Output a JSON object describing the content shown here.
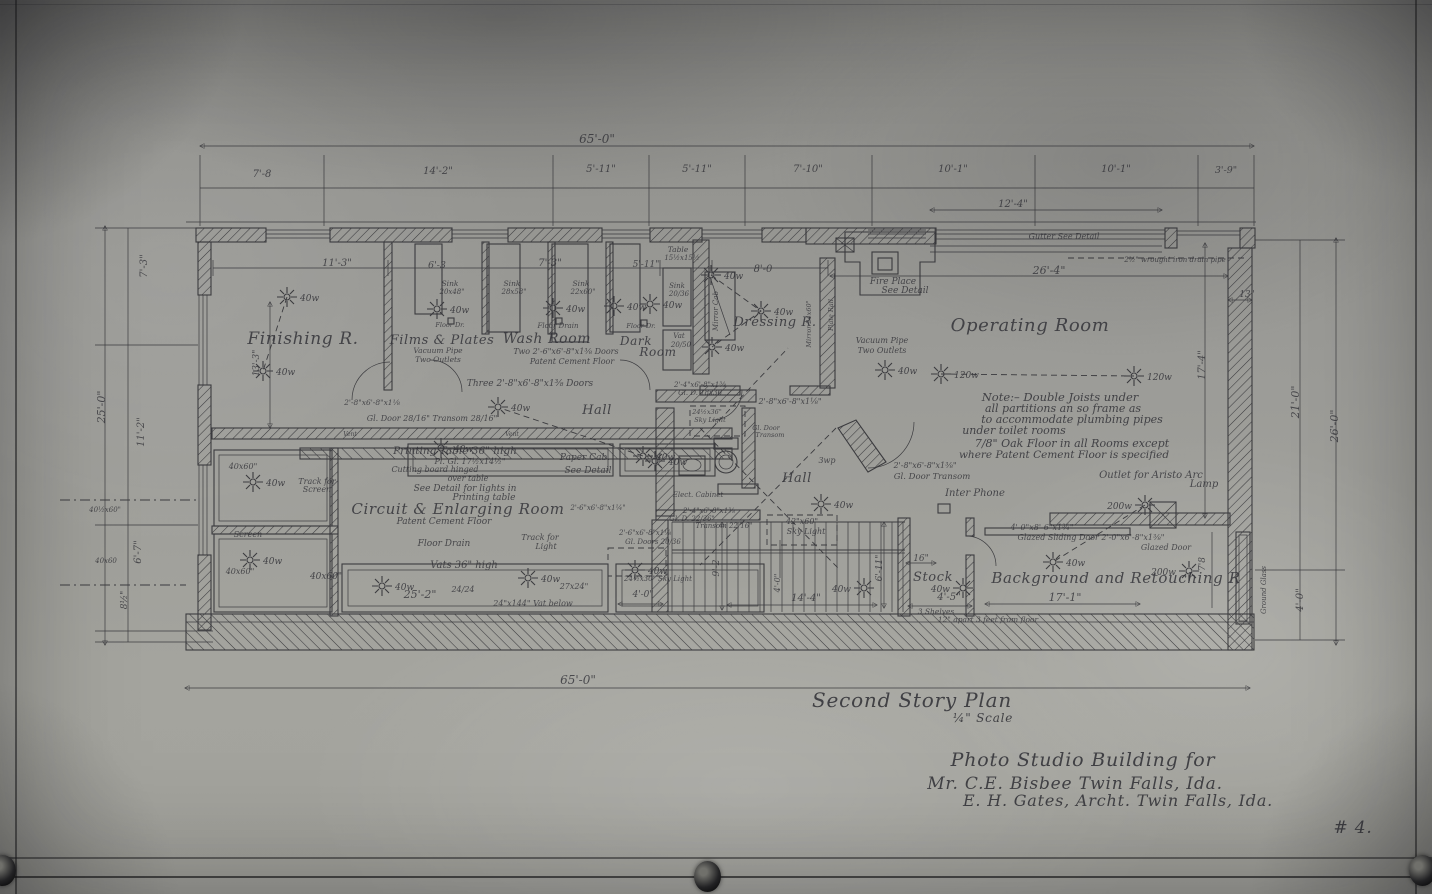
{
  "drawing": {
    "plan_title": "Second Story Plan",
    "scale": "¼\" Scale",
    "project": "Photo Studio Building for",
    "client": "Mr. C.E. Bisbee    Twin Falls, Ida.",
    "architect": "E. H. Gates, Archt.  Twin Falls, Ida.",
    "sheet_number": "# 4."
  },
  "colors": {
    "paper": "#9a9a96",
    "ink": "#26262b"
  },
  "texts": [
    {
      "t": "Finishing R.",
      "x": 303,
      "y": 344,
      "s": 17,
      "st": "room",
      "n": "room-label-finishing"
    },
    {
      "t": "Films & Plates",
      "x": 442,
      "y": 344,
      "s": 13,
      "st": "room",
      "n": "room-label-films-plates"
    },
    {
      "t": "Wash Room",
      "x": 547,
      "y": 343,
      "s": 14,
      "st": "room",
      "n": "room-label-wash-room"
    },
    {
      "t": "Dark",
      "x": 636,
      "y": 345,
      "s": 12,
      "st": "room",
      "n": "room-label-dark"
    },
    {
      "t": "Room",
      "x": 658,
      "y": 356,
      "s": 12,
      "st": "room",
      "n": "room-label-dark-2"
    },
    {
      "t": "Dressing R.",
      "x": 775,
      "y": 326,
      "s": 13,
      "st": "room",
      "n": "room-label-dressing"
    },
    {
      "t": "Operating Room",
      "x": 1030,
      "y": 331,
      "s": 18,
      "st": "room",
      "n": "room-label-operating"
    },
    {
      "t": "Hall",
      "x": 597,
      "y": 414,
      "s": 13,
      "st": "room",
      "n": "room-label-hall-1"
    },
    {
      "t": "Hall",
      "x": 797,
      "y": 482,
      "s": 13,
      "st": "room",
      "n": "room-label-hall-2"
    },
    {
      "t": "Circuit & Enlarging Room",
      "x": 458,
      "y": 514,
      "s": 15,
      "st": "room",
      "n": "room-label-enlarging"
    },
    {
      "t": "Stock",
      "x": 933,
      "y": 581,
      "s": 13,
      "st": "room",
      "n": "room-label-stock"
    },
    {
      "t": "Background and Retouching R",
      "x": 1116,
      "y": 583,
      "s": 15,
      "st": "room",
      "n": "room-label-background"
    },
    {
      "t": "Second Story Plan",
      "x": 912,
      "y": 707,
      "s": 20,
      "st": "t",
      "n": "plan-title"
    },
    {
      "t": "¼\" Scale",
      "x": 983,
      "y": 722,
      "s": 12,
      "st": "t",
      "n": "plan-scale"
    },
    {
      "t": "Photo Studio Building for",
      "x": 1083,
      "y": 766,
      "s": 19,
      "st": "t",
      "n": "project-title"
    },
    {
      "t": "Mr. C.E. Bisbee    Twin Falls, Ida.",
      "x": 1075,
      "y": 789,
      "s": 17,
      "st": "t",
      "n": "client-line"
    },
    {
      "t": "E. H. Gates, Archt.  Twin Falls, Ida.",
      "x": 1118,
      "y": 806,
      "s": 16,
      "st": "t",
      "n": "architect-line"
    },
    {
      "t": "# 4.",
      "x": 1353,
      "y": 833,
      "s": 17,
      "st": "t",
      "n": "sheet-number"
    },
    {
      "t": "Note:– Double Joists under",
      "x": 1060,
      "y": 401,
      "s": 11.5,
      "st": "n"
    },
    {
      "t": "all partitions an so frame as",
      "x": 1063,
      "y": 412,
      "s": 11,
      "st": "n"
    },
    {
      "t": "to accommodate plumbing pipes",
      "x": 1072,
      "y": 423,
      "s": 11,
      "st": "n"
    },
    {
      "t": "under toilet rooms",
      "x": 1014,
      "y": 434,
      "s": 11,
      "st": "n"
    },
    {
      "t": "7/8\" Oak Floor in all Rooms except",
      "x": 1072,
      "y": 447,
      "s": 11,
      "st": "n"
    },
    {
      "t": "where Patent Cement Floor is specified",
      "x": 1064,
      "y": 458,
      "s": 10.5,
      "st": "n"
    },
    {
      "t": "65'-0\"",
      "x": 597,
      "y": 143,
      "s": 12,
      "st": "d"
    },
    {
      "t": "7'-8",
      "x": 262,
      "y": 177,
      "s": 10,
      "st": "d"
    },
    {
      "t": "14'-2\"",
      "x": 438,
      "y": 174,
      "s": 10,
      "st": "d"
    },
    {
      "t": "5'-11\"",
      "x": 601,
      "y": 172,
      "s": 10,
      "st": "d"
    },
    {
      "t": "5'-11\"",
      "x": 697,
      "y": 172,
      "s": 10,
      "st": "d"
    },
    {
      "t": "7'-10\"",
      "x": 808,
      "y": 172,
      "s": 10,
      "st": "d"
    },
    {
      "t": "10'-1\"",
      "x": 953,
      "y": 172,
      "s": 10,
      "st": "d"
    },
    {
      "t": "10'-1\"",
      "x": 1116,
      "y": 172,
      "s": 10,
      "st": "d"
    },
    {
      "t": "3'-9\"",
      "x": 1226,
      "y": 173,
      "s": 9.5,
      "st": "d"
    },
    {
      "t": "12'-4\"",
      "x": 1013,
      "y": 207,
      "s": 10,
      "st": "d"
    },
    {
      "t": "26'-4\"",
      "x": 1049,
      "y": 274,
      "s": 11,
      "st": "d"
    },
    {
      "t": "13\"",
      "x": 1247,
      "y": 297,
      "s": 9,
      "st": "d"
    },
    {
      "t": "11'-3\"",
      "x": 337,
      "y": 266,
      "s": 10,
      "st": "d"
    },
    {
      "t": "6'-3",
      "x": 437,
      "y": 268,
      "s": 9.5,
      "st": "d"
    },
    {
      "t": "7'-3\"",
      "x": 550,
      "y": 266,
      "s": 10,
      "st": "d"
    },
    {
      "t": "5'-11\"",
      "x": 646,
      "y": 267,
      "s": 9,
      "st": "d"
    },
    {
      "t": "8'-0",
      "x": 763,
      "y": 272,
      "s": 10,
      "st": "d"
    },
    {
      "t": "65'-0\"",
      "x": 578,
      "y": 684,
      "s": 12,
      "st": "d"
    },
    {
      "t": "25'-2\"",
      "x": 420,
      "y": 598,
      "s": 11,
      "st": "d"
    },
    {
      "t": "14'-4\"",
      "x": 806,
      "y": 601,
      "s": 10,
      "st": "d"
    },
    {
      "t": "17'-1\"",
      "x": 1065,
      "y": 601,
      "s": 11,
      "st": "d"
    },
    {
      "t": "4'-5\"",
      "x": 949,
      "y": 600,
      "s": 10,
      "st": "d"
    },
    {
      "t": "16\"",
      "x": 921,
      "y": 561,
      "s": 9,
      "st": "d"
    },
    {
      "t": "4'-0\"",
      "x": 643,
      "y": 597,
      "s": 9,
      "st": "d"
    },
    {
      "t": "7'-3\"",
      "x": 147,
      "y": 266,
      "s": 10,
      "r": -90,
      "st": "d"
    },
    {
      "t": "25'-0\"",
      "x": 105,
      "y": 407,
      "s": 11,
      "r": -90,
      "st": "d"
    },
    {
      "t": "11'-2\"",
      "x": 144,
      "y": 432,
      "s": 10,
      "r": -90,
      "st": "d"
    },
    {
      "t": "6'-7\"",
      "x": 141,
      "y": 552,
      "s": 10,
      "r": -90,
      "st": "d"
    },
    {
      "t": "8½\"",
      "x": 127,
      "y": 600,
      "s": 9,
      "r": -90,
      "st": "d"
    },
    {
      "t": "13'-3\"",
      "x": 259,
      "y": 363,
      "s": 9,
      "r": -90,
      "st": "d"
    },
    {
      "t": "17'-4\"",
      "x": 1205,
      "y": 365,
      "s": 10,
      "r": -90,
      "st": "d"
    },
    {
      "t": "21'-0\"",
      "x": 1299,
      "y": 402,
      "s": 11,
      "r": -90,
      "st": "d"
    },
    {
      "t": "26'-0\"",
      "x": 1338,
      "y": 426,
      "s": 11,
      "r": -90,
      "st": "d"
    },
    {
      "t": "4'-0\"",
      "x": 1303,
      "y": 600,
      "s": 10,
      "r": -90,
      "st": "d"
    },
    {
      "t": "7'8",
      "x": 1205,
      "y": 564,
      "s": 9,
      "r": -90,
      "st": "d"
    },
    {
      "t": "9'-2",
      "x": 719,
      "y": 568,
      "s": 9,
      "r": -90,
      "st": "d"
    },
    {
      "t": "6'-11\"",
      "x": 882,
      "y": 568,
      "s": 9,
      "r": -90,
      "st": "d"
    },
    {
      "t": "4'-0\"",
      "x": 780,
      "y": 583,
      "s": 8,
      "r": -90,
      "st": "d"
    },
    {
      "t": "Table",
      "x": 678,
      "y": 252,
      "s": 7.5,
      "st": "a"
    },
    {
      "t": "15½x15½",
      "x": 682,
      "y": 260,
      "s": 7,
      "st": "a"
    },
    {
      "t": "Sink",
      "x": 450,
      "y": 286,
      "s": 7.5,
      "st": "a"
    },
    {
      "t": "20x48\"",
      "x": 452,
      "y": 294,
      "s": 7,
      "st": "a"
    },
    {
      "t": "Sink",
      "x": 512,
      "y": 286,
      "s": 7.5,
      "st": "a"
    },
    {
      "t": "28x58\"",
      "x": 514,
      "y": 294,
      "s": 7,
      "st": "a"
    },
    {
      "t": "Sink",
      "x": 581,
      "y": 286,
      "s": 7.5,
      "st": "a"
    },
    {
      "t": "22x60\"",
      "x": 583,
      "y": 294,
      "s": 7,
      "st": "a"
    },
    {
      "t": "Sink",
      "x": 677,
      "y": 288,
      "s": 7,
      "st": "a"
    },
    {
      "t": "20/36",
      "x": 679,
      "y": 296,
      "s": 7,
      "st": "a"
    },
    {
      "t": "Floor Dr.",
      "x": 450,
      "y": 327,
      "s": 6.5,
      "st": "a"
    },
    {
      "t": "Floor Drain",
      "x": 558,
      "y": 328,
      "s": 7,
      "st": "a"
    },
    {
      "t": "Floor Dr.",
      "x": 641,
      "y": 328,
      "s": 6.5,
      "st": "a"
    },
    {
      "t": "Vat",
      "x": 679,
      "y": 338,
      "s": 7,
      "st": "a"
    },
    {
      "t": "20/50",
      "x": 681,
      "y": 347,
      "s": 7,
      "st": "a"
    },
    {
      "t": "Fire Place",
      "x": 893,
      "y": 284,
      "s": 9,
      "st": "a"
    },
    {
      "t": "See Detail",
      "x": 905,
      "y": 293,
      "s": 9,
      "st": "a"
    },
    {
      "t": "Gutter See Detail",
      "x": 1064,
      "y": 239,
      "s": 8,
      "st": "a"
    },
    {
      "t": "2½\" wrought iron drain pipe",
      "x": 1175,
      "y": 262,
      "s": 7,
      "st": "a"
    },
    {
      "t": "Vacuum Pipe",
      "x": 438,
      "y": 353,
      "s": 7.5,
      "st": "a"
    },
    {
      "t": "Two Outlets",
      "x": 438,
      "y": 362,
      "s": 7.5,
      "st": "a"
    },
    {
      "t": "Two  2'-6\"x6'-8\"x1⅜  Doors",
      "x": 566,
      "y": 354,
      "s": 8,
      "st": "a"
    },
    {
      "t": "Patent Cement Floor",
      "x": 572,
      "y": 364,
      "s": 8,
      "st": "a"
    },
    {
      "t": "Three  2'-8\"x6'-8\"x1⅜  Doors",
      "x": 530,
      "y": 386,
      "s": 9,
      "st": "a"
    },
    {
      "t": "2'-8\"x6'-8\"x1⅛",
      "x": 372,
      "y": 405,
      "s": 7.5,
      "st": "a"
    },
    {
      "t": "Gl. Door 28/16\"  Transom 28/16\"",
      "x": 432,
      "y": 421,
      "s": 8,
      "st": "a"
    },
    {
      "t": "Mirror Cab",
      "x": 718,
      "y": 311,
      "s": 7,
      "r": -90,
      "st": "a"
    },
    {
      "t": "Mirror 24x60\"",
      "x": 811,
      "y": 324,
      "s": 6.5,
      "r": -90,
      "st": "a"
    },
    {
      "t": "Plate Rail",
      "x": 833,
      "y": 315,
      "s": 6.5,
      "r": -90,
      "st": "a"
    },
    {
      "t": "Vacuum Pipe",
      "x": 882,
      "y": 343,
      "s": 8,
      "st": "a"
    },
    {
      "t": "Two Outlets",
      "x": 882,
      "y": 353,
      "s": 8,
      "st": "a"
    },
    {
      "t": "2'-4\"x6'-8\"x1⅜",
      "x": 700,
      "y": 387,
      "s": 7,
      "st": "a"
    },
    {
      "t": "Gl. D. 18x36",
      "x": 700,
      "y": 395,
      "s": 7,
      "st": "a"
    },
    {
      "t": "24½x36\"",
      "x": 707,
      "y": 414,
      "s": 6.5,
      "st": "a"
    },
    {
      "t": "Sky Light",
      "x": 710,
      "y": 422,
      "s": 6.5,
      "st": "a"
    },
    {
      "t": "2'-8\"x6'-8\"x1⅛\"",
      "x": 790,
      "y": 404,
      "s": 8,
      "st": "a"
    },
    {
      "t": "Gl. Door",
      "x": 766,
      "y": 430,
      "s": 6.5,
      "st": "a"
    },
    {
      "t": "Transom",
      "x": 770,
      "y": 437,
      "s": 6.5,
      "st": "a"
    },
    {
      "t": "3wp",
      "x": 827,
      "y": 463,
      "s": 8,
      "st": "a"
    },
    {
      "t": "2'-8\"x6'-8\"x1⅜\"",
      "x": 925,
      "y": 468,
      "s": 8,
      "st": "a"
    },
    {
      "t": "Gl. Door Transom",
      "x": 932,
      "y": 479,
      "s": 8.5,
      "st": "a"
    },
    {
      "t": "Inter Phone",
      "x": 975,
      "y": 496,
      "s": 10,
      "st": "a"
    },
    {
      "t": "Elect. Cabinet",
      "x": 698,
      "y": 497,
      "s": 7,
      "st": "a"
    },
    {
      "t": "Printing Table 36\" high",
      "x": 455,
      "y": 454,
      "s": 10.5,
      "st": "a"
    },
    {
      "t": "Pl. Gl. 17½x14½\"",
      "x": 470,
      "y": 464,
      "s": 8,
      "st": "a"
    },
    {
      "t": "Cutting board hinged",
      "x": 435,
      "y": 472,
      "s": 8,
      "st": "a"
    },
    {
      "t": "Paper Cab.",
      "x": 585,
      "y": 460,
      "s": 9,
      "st": "a"
    },
    {
      "t": "See Detail",
      "x": 588,
      "y": 473,
      "s": 9,
      "st": "a"
    },
    {
      "t": "Track for",
      "x": 317,
      "y": 484,
      "s": 8,
      "st": "a"
    },
    {
      "t": "Screen",
      "x": 317,
      "y": 492,
      "s": 8,
      "st": "a"
    },
    {
      "t": "over table",
      "x": 468,
      "y": 481,
      "s": 8,
      "st": "a"
    },
    {
      "t": "See Detail  for lights in",
      "x": 465,
      "y": 491,
      "s": 9,
      "st": "a"
    },
    {
      "t": "Printing  table",
      "x": 484,
      "y": 500,
      "s": 9,
      "st": "a"
    },
    {
      "t": "Patent Cement Floor",
      "x": 444,
      "y": 524,
      "s": 9,
      "st": "a"
    },
    {
      "t": "Floor Drain",
      "x": 444,
      "y": 546,
      "s": 9,
      "st": "a"
    },
    {
      "t": "Track for",
      "x": 540,
      "y": 540,
      "s": 8,
      "st": "a"
    },
    {
      "t": "Light",
      "x": 546,
      "y": 549,
      "s": 8,
      "st": "a"
    },
    {
      "t": "Vats  36\" high",
      "x": 464,
      "y": 568,
      "s": 10,
      "st": "a"
    },
    {
      "t": "40x60\"",
      "x": 243,
      "y": 469,
      "s": 8,
      "st": "a"
    },
    {
      "t": "Screen",
      "x": 248,
      "y": 537,
      "s": 8,
      "st": "a"
    },
    {
      "t": "40x60\"",
      "x": 240,
      "y": 574,
      "s": 8,
      "st": "a"
    },
    {
      "t": "40x60\"",
      "x": 326,
      "y": 579,
      "s": 9,
      "st": "a"
    },
    {
      "t": "40½x60\"",
      "x": 105,
      "y": 512,
      "s": 7,
      "st": "a"
    },
    {
      "t": "40x60",
      "x": 106,
      "y": 563,
      "s": 7,
      "st": "a"
    },
    {
      "t": "24/24",
      "x": 463,
      "y": 592,
      "s": 8,
      "st": "a"
    },
    {
      "t": "27x24\"",
      "x": 574,
      "y": 589,
      "s": 8,
      "st": "a"
    },
    {
      "t": "24\"x144\" Vat below",
      "x": 533,
      "y": 606,
      "s": 8,
      "st": "a"
    },
    {
      "t": "2'-6\"x6'-8\"x1¼\"",
      "x": 598,
      "y": 510,
      "s": 7,
      "st": "a"
    },
    {
      "t": "2'-6\"x6'-8\"x1⅛",
      "x": 645,
      "y": 535,
      "s": 7,
      "st": "a"
    },
    {
      "t": "Gl. Doors 20/36",
      "x": 653,
      "y": 544,
      "s": 7,
      "st": "a"
    },
    {
      "t": "2'-4\"x6'-8\"x1⅜",
      "x": 709,
      "y": 513,
      "s": 7,
      "st": "a"
    },
    {
      "t": "Gl. D. 22/36\"",
      "x": 692,
      "y": 521,
      "s": 7,
      "st": "a"
    },
    {
      "t": "Transom 22/16\"",
      "x": 724,
      "y": 528,
      "s": 7,
      "st": "a"
    },
    {
      "t": "42\"x60\"",
      "x": 802,
      "y": 524,
      "s": 8,
      "st": "a"
    },
    {
      "t": "Sky Light",
      "x": 806,
      "y": 534,
      "s": 8,
      "st": "a"
    },
    {
      "t": "24½x30\" Sky Light",
      "x": 658,
      "y": 581,
      "s": 7,
      "st": "a"
    },
    {
      "t": "Outlet for Aristo Arc",
      "x": 1151,
      "y": 478,
      "s": 10,
      "st": "a"
    },
    {
      "t": "Lamp",
      "x": 1204,
      "y": 487,
      "s": 10,
      "st": "a"
    },
    {
      "t": "4'-0\"x8'-6\"x1¾\"",
      "x": 1042,
      "y": 530,
      "s": 8,
      "st": "a"
    },
    {
      "t": "Glazed Sliding Door  2'-0\"x6'-8\"x1⅜\"",
      "x": 1091,
      "y": 540,
      "s": 8,
      "st": "a"
    },
    {
      "t": "Glazed Door",
      "x": 1166,
      "y": 550,
      "s": 8,
      "st": "a"
    },
    {
      "t": "3 Shelves",
      "x": 936,
      "y": 614,
      "s": 7.5,
      "st": "a"
    },
    {
      "t": "12\" apart  3 feet from floor",
      "x": 988,
      "y": 622,
      "s": 7.5,
      "st": "a"
    },
    {
      "t": "Ground Glass",
      "x": 1266,
      "y": 590,
      "s": 7,
      "r": -90,
      "st": "a"
    },
    {
      "t": "Vent",
      "x": 350,
      "y": 436,
      "s": 6,
      "st": "a"
    },
    {
      "t": "Vent",
      "x": 512,
      "y": 436,
      "s": 6,
      "st": "a"
    }
  ],
  "lights": [
    {
      "x": 287,
      "y": 297,
      "w": "40w"
    },
    {
      "x": 263,
      "y": 371,
      "w": "40w"
    },
    {
      "x": 437,
      "y": 309,
      "w": "40w"
    },
    {
      "x": 553,
      "y": 308,
      "w": "40w"
    },
    {
      "x": 614,
      "y": 306,
      "w": "40w"
    },
    {
      "x": 650,
      "y": 304,
      "w": "40w"
    },
    {
      "x": 711,
      "y": 275,
      "w": "40w"
    },
    {
      "x": 761,
      "y": 311,
      "w": "40w"
    },
    {
      "x": 712,
      "y": 347,
      "w": "40w"
    },
    {
      "x": 498,
      "y": 407,
      "w": "40w"
    },
    {
      "x": 821,
      "y": 504,
      "w": "40w"
    },
    {
      "x": 885,
      "y": 370,
      "w": "40w"
    },
    {
      "x": 941,
      "y": 374,
      "w": "120w"
    },
    {
      "x": 1134,
      "y": 376,
      "w": "120w"
    },
    {
      "x": 643,
      "y": 456,
      "w": "40w"
    },
    {
      "x": 253,
      "y": 482,
      "w": "40w"
    },
    {
      "x": 250,
      "y": 560,
      "w": "40w"
    },
    {
      "x": 382,
      "y": 586,
      "w": "40w"
    },
    {
      "x": 528,
      "y": 578,
      "w": "40w"
    },
    {
      "x": 864,
      "y": 588,
      "w": "40w",
      "side": "l"
    },
    {
      "x": 635,
      "y": 570,
      "w": "40w"
    },
    {
      "x": 963,
      "y": 588,
      "w": "40w",
      "side": "l"
    },
    {
      "x": 1145,
      "y": 505,
      "w": "200w",
      "side": "l"
    },
    {
      "x": 1189,
      "y": 571,
      "w": "200w",
      "side": "l"
    },
    {
      "x": 1053,
      "y": 562,
      "w": "40w"
    },
    {
      "x": 441,
      "y": 448,
      "w": "40w"
    },
    {
      "x": 655,
      "y": 461,
      "w": "40w"
    }
  ]
}
